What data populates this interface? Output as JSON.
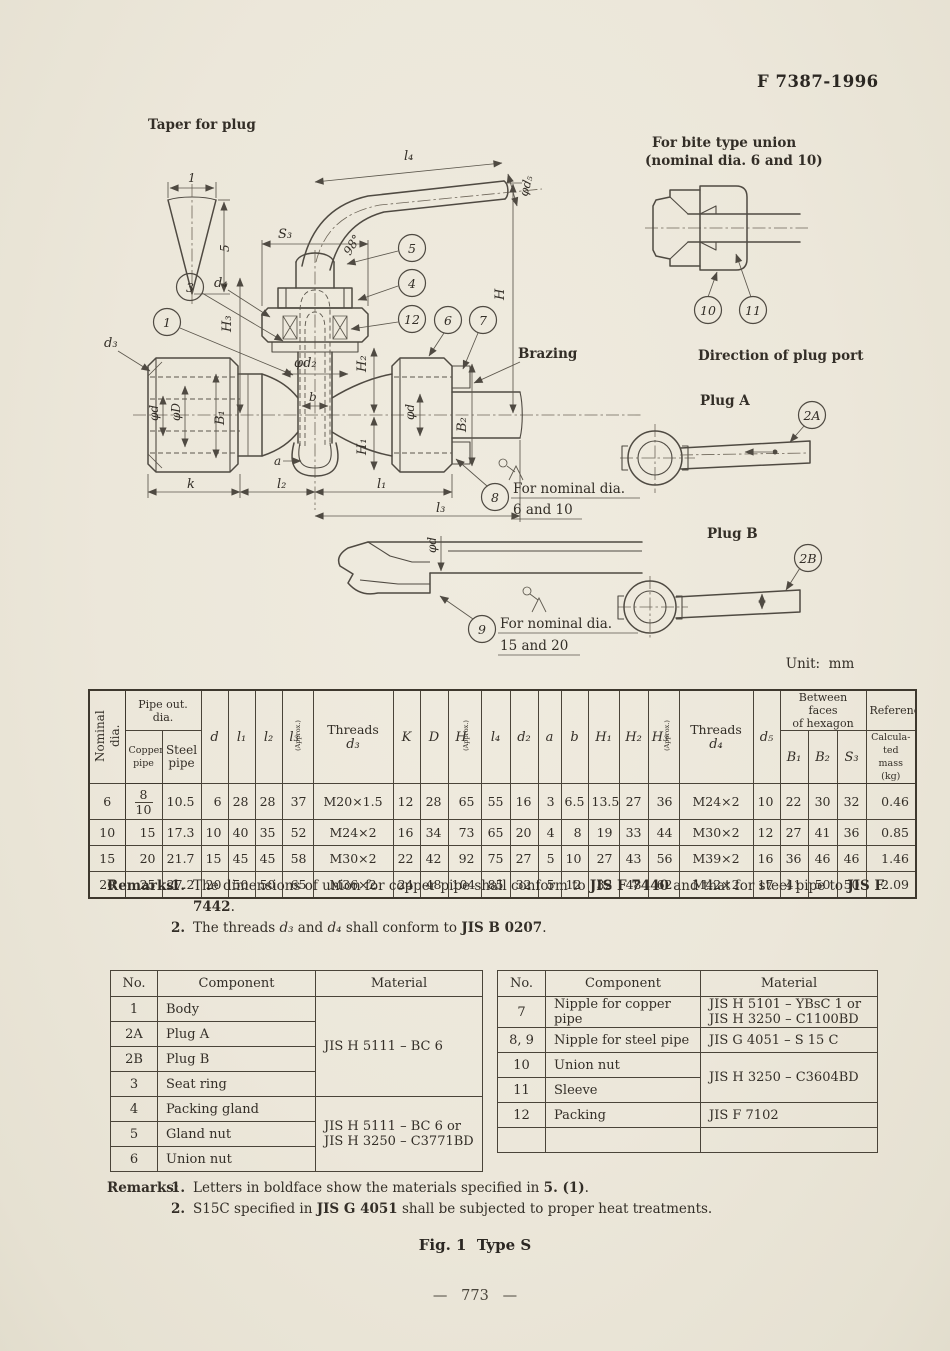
{
  "page": {
    "doc_number": "F 7387-1996",
    "unit_label": "Unit:  mm",
    "fig_caption": "Fig. 1  Type S",
    "page_number": "—   773   —"
  },
  "drawing": {
    "annotations": {
      "taper_title": "Taper for plug",
      "taper_width": "1",
      "taper_height": "5",
      "bite_union_1": "For bite type union",
      "bite_union_2": "(nominal dia. 6 and 10)",
      "direction_heading": "Direction of plug port",
      "plug_a": "Plug A",
      "plug_b": "Plug B",
      "brazing": "Brazing",
      "note8_1": "For nominal dia.",
      "note8_2": "6 and 10",
      "note9_1": "For nominal dia.",
      "note9_2": "15 and 20"
    },
    "dims": {
      "l4": "l₄",
      "phi_d5": "φd₅",
      "s3": "S₃",
      "angle": "98°",
      "H": "H",
      "d4": "d₄",
      "H3": "H₃",
      "d3": "d₃",
      "phi_d2": "φd₂",
      "b": "b",
      "a": "a",
      "phi_d": "φd",
      "phi_D": "φD",
      "B1": "B₁",
      "H2": "H₂",
      "H1": "H₁",
      "B2": "B₂",
      "k": "k",
      "l2": "l₂",
      "l1": "l₁",
      "l3": "l₃"
    },
    "balloons": {
      "b1": "1",
      "b2a": "2A",
      "b2b": "2B",
      "b3": "3",
      "b4": "4",
      "b5": "5",
      "b6": "6",
      "b7": "7",
      "b8": "8",
      "b9": "9",
      "b10": "10",
      "b11": "11",
      "b12": "12"
    }
  },
  "dim_table": {
    "h": {
      "nominal": "Nominal dia.",
      "pipe_out": "Pipe out. dia.",
      "copper": "Copper pipe",
      "steel": "Steel pipe",
      "d": "d",
      "l1": "l₁",
      "l2": "l₂",
      "l3": "l₃",
      "threads": "Threads",
      "d3": "d₃",
      "K": "K",
      "D": "D",
      "H": "H",
      "l4": "l₄",
      "d2": "d₂",
      "a": "a",
      "b": "b",
      "H1": "H₁",
      "H2": "H₂",
      "H3": "H₃",
      "d4": "d₄",
      "d5": "d₅",
      "between1": "Between faces",
      "between2": "of hexagon",
      "B1": "B₁",
      "B2": "B₂",
      "S3": "S₃",
      "reference": "Reference",
      "approx": "(Approx.)",
      "mass1": "Calcula-",
      "mass2": "ted mass",
      "mass3": "(kg)"
    },
    "rows": [
      {
        "nominal": "6",
        "copper_top": "8",
        "copper_bot": "10",
        "steel": "10.5",
        "c": [
          "6",
          "28",
          "28",
          "37",
          "M20×1.5",
          "12",
          "28",
          "65",
          "55",
          "16",
          "3",
          "6.5",
          "13.5",
          "27",
          "36",
          "M24×2",
          "10",
          "22",
          "30",
          "32",
          "0.46"
        ]
      },
      {
        "nominal": "10",
        "copper": "15",
        "steel": "17.3",
        "c": [
          "10",
          "40",
          "35",
          "52",
          "M24×2",
          "16",
          "34",
          "73",
          "65",
          "20",
          "4",
          "8",
          "19",
          "33",
          "44",
          "M30×2",
          "12",
          "27",
          "41",
          "36",
          "0.85"
        ]
      },
      {
        "nominal": "15",
        "copper": "20",
        "steel": "21.7",
        "c": [
          "15",
          "45",
          "45",
          "58",
          "M30×2",
          "22",
          "42",
          "92",
          "75",
          "27",
          "5",
          "10",
          "27",
          "43",
          "56",
          "M39×2",
          "16",
          "36",
          "46",
          "46",
          "1.46"
        ]
      },
      {
        "nominal": "20",
        "copper": "25",
        "steel": "27.2",
        "c": [
          "20",
          "50",
          "50",
          "65",
          "M36×2",
          "24",
          "48",
          "104",
          "85",
          "32",
          "5",
          "12",
          "32",
          "48",
          "62",
          "M42×2",
          "17",
          "41",
          "50",
          "50",
          "2.09"
        ]
      }
    ]
  },
  "remarks_top": {
    "label": "Remarks:",
    "r1_num": "1.",
    "r1_parts": [
      "The dimensions of union for copper pipe shall conform to ",
      "JIS F 7440",
      " and that for steel pipe to ",
      "JIS F 7442",
      "."
    ],
    "r2_num": "2.",
    "r2_parts": [
      "The threads ",
      "d₃",
      " and ",
      "d₄",
      " shall conform to ",
      "JIS B 0207",
      "."
    ]
  },
  "materials_left": {
    "h": {
      "no": "No.",
      "component": "Component",
      "material": "Material"
    },
    "rows": {
      "r1": {
        "no": "1",
        "component": "Body"
      },
      "r2a": {
        "no": "2A",
        "component": "Plug A"
      },
      "r2b": {
        "no": "2B",
        "component": "Plug B"
      },
      "r3": {
        "no": "3",
        "component": "Seat ring"
      },
      "r4": {
        "no": "4",
        "component": "Packing gland"
      },
      "r5": {
        "no": "5",
        "component": "Gland nut"
      },
      "r6": {
        "no": "6",
        "component": "Union nut"
      }
    },
    "mat_group1": "JIS H 5111 – BC 6",
    "mat_group2_line1": "JIS H 5111 – BC 6 or",
    "mat_group2_line2": "JIS H 3250 – C3771BD"
  },
  "materials_right": {
    "h": {
      "no": "No.",
      "component": "Component",
      "material": "Material"
    },
    "rows": {
      "r7": {
        "no": "7",
        "component": "Nipple for copper pipe",
        "mat_line1": "JIS H 5101 – YBsC 1 or",
        "mat_line2": "JIS H 3250 – C1100BD"
      },
      "r89": {
        "no": "8, 9",
        "component": "Nipple for steel pipe",
        "mat": "JIS G 4051 – S 15 C"
      },
      "r10": {
        "no": "10",
        "component": "Union nut"
      },
      "r11": {
        "no": "11",
        "component": "Sleeve"
      },
      "r12": {
        "no": "12",
        "component": "Packing",
        "mat": "JIS F 7102"
      }
    },
    "mat_group_10_11": "JIS H 3250 – C3604BD"
  },
  "remarks_bottom": {
    "label": "Remarks:",
    "r1_num": "1.",
    "r1_parts": [
      "Letters in boldface show the materials specified in ",
      "5. (1)",
      "."
    ],
    "r2_num": "2.",
    "r2_parts": [
      "S15C specified in ",
      "JIS G 4051",
      " shall be subjected to proper heat treatments."
    ]
  }
}
